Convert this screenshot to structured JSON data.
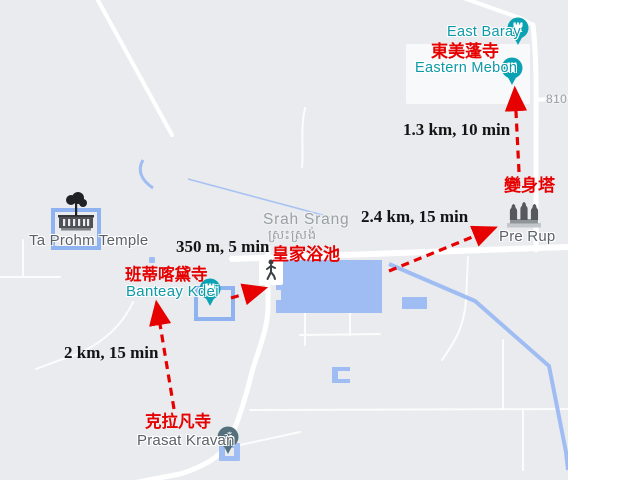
{
  "colors": {
    "map_background": "#e9ebee",
    "road": "#ffffff",
    "water": "#a0bdf3",
    "annotation_red": "#e60000",
    "annotation_black": "#141414",
    "poi_teal_pin": "#0ba3b4",
    "poi_teal_text": "#0d99a6",
    "minor_label_gray": "#9aa0a6",
    "place_label_dark": "#5b6166",
    "kravan_pin": "#55707d"
  },
  "places": {
    "east_baray": {
      "name": "East Baray"
    },
    "eastern_mebon": {
      "name": "Eastern Mebon",
      "name_zh": "東美蓬寺"
    },
    "pre_rup": {
      "name": "Pre Rup",
      "name_zh": "變身塔"
    },
    "srah_srang": {
      "name": "Srah Srang",
      "name_km": "ស្រះស្រង់",
      "name_zh": "皇家浴池"
    },
    "banteay_kdei": {
      "name": "Banteay Kdei",
      "name_zh": "班蒂喀黛寺"
    },
    "ta_prohm": {
      "name": "Ta Prohm Temple"
    },
    "prasat_kravan": {
      "name": "Prasat Kravan",
      "name_zh": "克拉凡寺"
    }
  },
  "routes": [
    {
      "from": "Banteay Kdei",
      "to": "Srah Srang",
      "label": "350 m, 5 min"
    },
    {
      "from": "Prasat Kravan",
      "to": "Banteay Kdei",
      "label": "2 km, 15 min"
    },
    {
      "from": "Srah Srang",
      "to": "Pre Rup",
      "label": "2.4 km, 15 min"
    },
    {
      "from": "Pre Rup",
      "to": "Eastern Mebon",
      "label": "1.3 km, 10 min"
    }
  ],
  "road_labels": [
    {
      "text": "810"
    }
  ]
}
